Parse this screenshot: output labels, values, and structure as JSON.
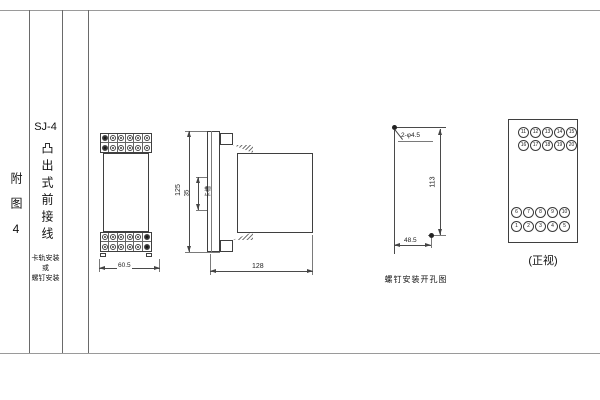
{
  "sidebar": {
    "figure_label": "附图4",
    "model": "SJ-4",
    "type_label": "凸出式前接线",
    "notes": [
      "卡轨安装",
      "或",
      "螺钉安装"
    ]
  },
  "front_view": {
    "width_dim": "60.5"
  },
  "side_view": {
    "height_dim": "125",
    "slot_dim": "35",
    "slot_label": "卡槽",
    "depth_dim": "128"
  },
  "hole_view": {
    "holes_label": "2-φ4.5",
    "vertical_dim": "113",
    "horizontal_dim": "48.5",
    "caption": "螺钉安装开孔图"
  },
  "terminal_view": {
    "caption": "(正视)",
    "rows": [
      [
        "11",
        "12",
        "13",
        "14",
        "15"
      ],
      [
        "16",
        "17",
        "18",
        "19",
        "20"
      ],
      [
        "6",
        "7",
        "8",
        "9",
        "10"
      ],
      [
        "1",
        "2",
        "3",
        "4",
        "5"
      ]
    ]
  }
}
